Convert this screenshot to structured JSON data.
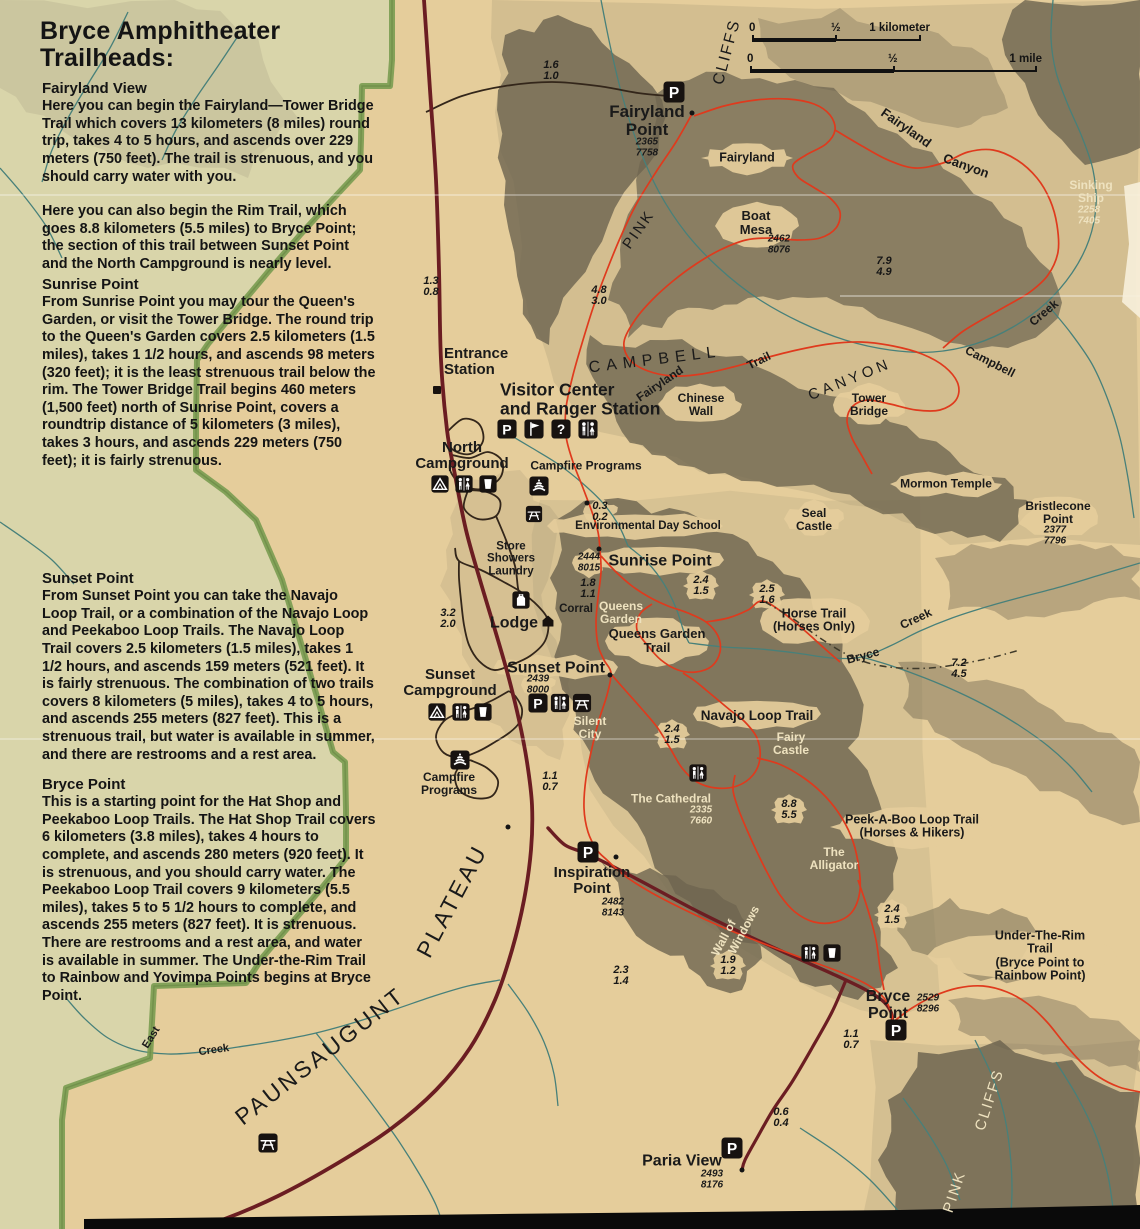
{
  "sidebar": {
    "title": "Bryce Amphitheater\nTrailheads:",
    "sections": [
      {
        "heading": "Fairyland View",
        "body": "Here you can begin the Fairyland—Tower Bridge Trail which covers 13 kilometers (8 miles) round trip, takes 4 to 5 hours, and ascends over 229 meters (750 feet). The trail is strenuous, and you should carry water with you."
      },
      {
        "heading": "",
        "body": "Here you can also begin the Rim Trail, which goes 8.8 kilometers (5.5 miles) to Bryce Point; the section of this trail between Sunset Point and the North Campground is nearly level."
      },
      {
        "heading": "Sunrise Point",
        "body": "From Sunrise Point you may tour the Queen's Garden, or visit the Tower Bridge. The round trip to the Queen's Garden covers 2.5 kilometers (1.5 miles), takes 1 1/2 hours, and ascends 98 meters (320 feet); it is the least strenuous trail below the rim. The Tower Bridge Trail begins 460 meters (1,500 feet) north of Sunrise Point, covers a roundtrip distance of 5 kilometers (3 miles), takes 3 hours, and ascends 229 meters (750 feet); it is fairly strenuous."
      },
      {
        "heading": "Sunset Point",
        "body": "From Sunset Point you can take the Navajo Loop Trail, or a combination of the Navajo Loop and Peekaboo Loop Trails. The Navajo Loop Trail covers 2.5 kilometers (1.5 miles), takes 1 1/2 hours, and ascends 159 meters (521 feet). It is fairly strenuous. The combination of two trails covers 8 kilometers (5 miles), takes 4 to 5 hours, and ascends 255 meters (827 feet). This is a strenuous trail, but water is available in summer, and there are restrooms and a rest area."
      },
      {
        "heading": "Bryce Point",
        "body": "This is a starting point for the Hat Shop and Peekaboo Loop Trails. The Hat Shop Trail covers 6 kilometers (3.8 miles), takes 4 hours to complete, and ascends 280 meters (920 feet). It is strenuous, and you should carry water. The Peekaboo Loop Trail covers 9 kilometers (5.5 miles), takes 5 to 5 1/2 hours to complete, and ascends 255 meters (827 feet). It is strenuous. There are restrooms and a rest area, and water is available in summer. The Under-the-Rim Trail to Rainbow and Yovimpa Points begins at Bryce Point."
      }
    ]
  },
  "scale_bars": {
    "km": {
      "zero": "0",
      "half": "½",
      "end": "1 kilometer"
    },
    "mile": {
      "zero": "0",
      "half": "½",
      "end": "1 mile"
    }
  },
  "colors": {
    "paper": "#e5cd9b",
    "outside": "#d9d5aa",
    "boundary": "#7c9d53",
    "road": "#6b1d22",
    "trail": "#df3a1d",
    "creek": "#47807a",
    "terrain_dark": "#6e6550",
    "terrain_mid": "#a89a78",
    "ink": "#1a1a1a",
    "cream": "#eee2bf",
    "icon_bg": "#171210"
  },
  "map": {
    "labels": [
      {
        "id": "cliffs-upper-label",
        "t": "CLIFFS",
        "x": 727,
        "y": 52,
        "fs": 16,
        "rot": -75,
        "w": 500,
        "ls": 2
      },
      {
        "id": "pink-upper-label",
        "t": "PINK",
        "x": 639,
        "y": 230,
        "fs": 15,
        "rot": -55,
        "w": 500,
        "ls": 2
      },
      {
        "id": "fairyland-point-label",
        "t": "Fairyland\nPoint",
        "x": 647,
        "y": 121,
        "fs": 17,
        "w": 800
      },
      {
        "id": "fairyland-point-elev",
        "t": "2365\n7758",
        "x": 647,
        "y": 148,
        "fs": 10,
        "w": 700,
        "it": 1
      },
      {
        "id": "fairyland-area-label",
        "t": "Fairyland",
        "x": 747,
        "y": 158,
        "fs": 12.5,
        "w": 600
      },
      {
        "id": "boat-mesa-label",
        "t": "Boat\nMesa",
        "x": 756,
        "y": 223,
        "fs": 13,
        "w": 600
      },
      {
        "id": "boat-mesa-elev",
        "t": "2462\n8076",
        "x": 779,
        "y": 245,
        "fs": 10,
        "w": 700,
        "it": 1
      },
      {
        "id": "sinking-ship-label",
        "t": "Sinking\nShip",
        "x": 1091,
        "y": 192,
        "fs": 12,
        "w": 600,
        "c": "cream"
      },
      {
        "id": "sinking-ship-elev",
        "t": "2258\n7405",
        "x": 1089,
        "y": 216,
        "fs": 10,
        "w": 700,
        "it": 1,
        "c": "cream"
      },
      {
        "id": "fairyland-canyon-label-1",
        "t": "Fairyland",
        "x": 906,
        "y": 128,
        "fs": 13,
        "rot": 35,
        "w": 600
      },
      {
        "id": "fairyland-canyon-label-2",
        "t": "Canyon",
        "x": 966,
        "y": 166,
        "fs": 13,
        "rot": 20,
        "w": 600
      },
      {
        "id": "campbell-creek-label-1",
        "t": "Campbell",
        "x": 990,
        "y": 362,
        "fs": 12,
        "rot": 27,
        "w": 600
      },
      {
        "id": "campbell-creek-label-2",
        "t": "Creek",
        "x": 1044,
        "y": 313,
        "fs": 12,
        "rot": -40,
        "w": 600
      },
      {
        "id": "campbell-canyon-letters-1",
        "t": "CAMPBELL",
        "x": 655,
        "y": 360,
        "fs": 16,
        "ls": 6,
        "rot": -7,
        "w": 500
      },
      {
        "id": "campbell-canyon-letters-2",
        "t": "CANYON",
        "x": 850,
        "y": 380,
        "fs": 15,
        "ls": 4,
        "rot": -22,
        "w": 500
      },
      {
        "id": "fairyland-trail-label-1",
        "t": "Fairyland",
        "x": 660,
        "y": 384,
        "fs": 12,
        "rot": -34,
        "w": 700
      },
      {
        "id": "fairyland-trail-label-2",
        "t": "Trail",
        "x": 759,
        "y": 361,
        "fs": 12,
        "rot": -26,
        "w": 700
      },
      {
        "id": "chinese-wall-label",
        "t": "Chinese\nWall",
        "x": 701,
        "y": 405,
        "fs": 12,
        "w": 600
      },
      {
        "id": "tower-bridge-label",
        "t": "Tower\nBridge",
        "x": 869,
        "y": 405,
        "fs": 12,
        "w": 600
      },
      {
        "id": "entrance-station-label",
        "t": "Entrance\nStation",
        "x": 444,
        "y": 362,
        "fs": 15,
        "w": 800,
        "al": "l"
      },
      {
        "id": "visitor-center-label",
        "t": "Visitor Center\nand Ranger Station",
        "x": 500,
        "y": 399,
        "fs": 17.5,
        "w": 800,
        "al": "l"
      },
      {
        "id": "north-campground-label",
        "t": "North\nCampground",
        "x": 462,
        "y": 456,
        "fs": 15,
        "w": 800
      },
      {
        "id": "campfire-programs-north-label",
        "t": "Campfire Programs",
        "x": 586,
        "y": 466,
        "fs": 12,
        "w": 600
      },
      {
        "id": "environmental-day-school-label",
        "t": "Environmental Day School",
        "x": 648,
        "y": 526,
        "fs": 11.5,
        "w": 600
      },
      {
        "id": "store-showers-laundry-label",
        "t": "Store\nShowers\nLaundry",
        "x": 511,
        "y": 559,
        "fs": 11.5,
        "w": 600
      },
      {
        "id": "sunrise-point-label",
        "t": "Sunrise Point",
        "x": 660,
        "y": 561,
        "fs": 16,
        "w": 800
      },
      {
        "id": "sunrise-point-elev",
        "t": "2444\n8015",
        "x": 589,
        "y": 563,
        "fs": 10,
        "w": 700,
        "it": 1
      },
      {
        "id": "corral-label",
        "t": "Corral",
        "x": 576,
        "y": 609,
        "fs": 11.5,
        "w": 600
      },
      {
        "id": "queens-garden-label",
        "t": "Queens\nGarden",
        "x": 621,
        "y": 613,
        "fs": 12,
        "w": 600,
        "c": "cream"
      },
      {
        "id": "queens-garden-trail-label",
        "t": "Queens Garden\nTrail",
        "x": 657,
        "y": 641,
        "fs": 13,
        "w": 800
      },
      {
        "id": "horse-trail-label",
        "t": "Horse Trail\n(Horses Only)",
        "x": 814,
        "y": 621,
        "fs": 12.5,
        "w": 800
      },
      {
        "id": "bryce-creek-label-1",
        "t": "Bryce",
        "x": 863,
        "y": 656,
        "fs": 12,
        "rot": -15,
        "w": 600
      },
      {
        "id": "bryce-creek-label-2",
        "t": "Creek",
        "x": 916,
        "y": 619,
        "fs": 12,
        "rot": -25,
        "w": 600
      },
      {
        "id": "lodge-label",
        "t": "Lodge",
        "x": 514,
        "y": 623,
        "fs": 16,
        "w": 800
      },
      {
        "id": "sunset-point-label",
        "t": "Sunset Point",
        "x": 556,
        "y": 668,
        "fs": 16,
        "w": 800
      },
      {
        "id": "sunset-point-elev",
        "t": "2439\n8000",
        "x": 538,
        "y": 685,
        "fs": 10,
        "w": 700,
        "it": 1
      },
      {
        "id": "sunset-campground-label",
        "t": "Sunset\nCampground",
        "x": 450,
        "y": 683,
        "fs": 15,
        "w": 800
      },
      {
        "id": "silent-city-label",
        "t": "Silent\nCity",
        "x": 590,
        "y": 728,
        "fs": 12,
        "w": 600,
        "c": "cream"
      },
      {
        "id": "navajo-loop-trail-label",
        "t": "Navajo Loop Trail",
        "x": 757,
        "y": 716,
        "fs": 13.5,
        "w": 800
      },
      {
        "id": "fairy-castle-label",
        "t": "Fairy\nCastle",
        "x": 791,
        "y": 744,
        "fs": 12,
        "w": 600,
        "c": "cream"
      },
      {
        "id": "the-cathedral-label",
        "t": "The Cathedral",
        "x": 671,
        "y": 799,
        "fs": 12,
        "w": 600,
        "c": "cream"
      },
      {
        "id": "the-cathedral-elev",
        "t": "2335\n7660",
        "x": 701,
        "y": 816,
        "fs": 10,
        "w": 700,
        "it": 1,
        "c": "cream"
      },
      {
        "id": "peek-a-boo-loop-trail-label",
        "t": "Peek-A-Boo Loop Trail\n(Horses & Hikers)",
        "x": 912,
        "y": 827,
        "fs": 12.5,
        "w": 800
      },
      {
        "id": "the-alligator-label",
        "t": "The\nAlligator",
        "x": 834,
        "y": 859,
        "fs": 12,
        "w": 600,
        "c": "cream"
      },
      {
        "id": "campfire-programs-south-label",
        "t": "Campfire\nPrograms",
        "x": 449,
        "y": 784,
        "fs": 12,
        "w": 600
      },
      {
        "id": "inspiration-point-label",
        "t": "Inspiration\nPoint",
        "x": 592,
        "y": 881,
        "fs": 15,
        "w": 800
      },
      {
        "id": "inspiration-point-elev",
        "t": "2482\n8143",
        "x": 613,
        "y": 908,
        "fs": 10,
        "w": 700,
        "it": 1
      },
      {
        "id": "wall-of-windows-label-1",
        "t": "Wall of",
        "x": 724,
        "y": 938,
        "fs": 12,
        "rot": -62,
        "w": 600,
        "c": "cream"
      },
      {
        "id": "wall-of-windows-label-2",
        "t": "Windows",
        "x": 744,
        "y": 930,
        "fs": 12,
        "rot": -62,
        "w": 600,
        "c": "cream"
      },
      {
        "id": "bryce-point-label",
        "t": "Bryce\nPoint",
        "x": 888,
        "y": 1005,
        "fs": 16,
        "w": 800
      },
      {
        "id": "bryce-point-elev",
        "t": "2529\n8296",
        "x": 928,
        "y": 1004,
        "fs": 10,
        "w": 700,
        "it": 1
      },
      {
        "id": "under-the-rim-trail-label",
        "t": "Under-The-Rim Trail\n(Bryce Point to Rainbow Point)",
        "x": 1040,
        "y": 956,
        "fs": 12.5,
        "w": 800
      },
      {
        "id": "paria-view-label",
        "t": "Paria View",
        "x": 682,
        "y": 1161,
        "fs": 16,
        "w": 800
      },
      {
        "id": "paria-view-elev",
        "t": "2493\n8176",
        "x": 712,
        "y": 1180,
        "fs": 10,
        "w": 700,
        "it": 1
      },
      {
        "id": "paunsaugunt-label",
        "t": "PAUNSAUGUNT",
        "x": 320,
        "y": 1056,
        "fs": 23,
        "ls": 3,
        "rot": -38,
        "w": 500
      },
      {
        "id": "plateau-label",
        "t": "PLATEAU",
        "x": 452,
        "y": 901,
        "fs": 23,
        "ls": 3,
        "rot": -62,
        "w": 500
      },
      {
        "id": "east-creek-label-1",
        "t": "East",
        "x": 152,
        "y": 1038,
        "fs": 11,
        "rot": -58,
        "w": 600
      },
      {
        "id": "east-creek-label-2",
        "t": "Creek",
        "x": 214,
        "y": 1051,
        "fs": 11,
        "rot": -8,
        "w": 600
      },
      {
        "id": "pink-lower-label",
        "t": "PINK",
        "x": 955,
        "y": 1192,
        "fs": 15,
        "rot": -72,
        "w": 500,
        "ls": 2,
        "c": "cream"
      },
      {
        "id": "cliffs-lower-label",
        "t": "CLIFFS",
        "x": 990,
        "y": 1100,
        "fs": 15,
        "rot": -72,
        "w": 500,
        "ls": 2,
        "c": "cream"
      },
      {
        "id": "mormon-temple-label",
        "t": "Mormon Temple",
        "x": 946,
        "y": 484,
        "fs": 12,
        "w": 600
      },
      {
        "id": "seal-castle-label",
        "t": "Seal\nCastle",
        "x": 814,
        "y": 520,
        "fs": 12,
        "w": 600
      },
      {
        "id": "bristlecone-point-label",
        "t": "Bristlecone\nPoint",
        "x": 1058,
        "y": 513,
        "fs": 12,
        "w": 600
      },
      {
        "id": "bristlecone-point-elev",
        "t": "2377\n7796",
        "x": 1055,
        "y": 536,
        "fs": 10,
        "w": 700,
        "it": 1
      }
    ],
    "distances": [
      {
        "x": 551,
        "y": 71,
        "a": "1.6",
        "b": "1.0"
      },
      {
        "x": 431,
        "y": 287,
        "a": "1.3",
        "b": "0.8"
      },
      {
        "x": 599,
        "y": 296,
        "a": "4.8",
        "b": "3.0"
      },
      {
        "x": 884,
        "y": 267,
        "a": "7.9",
        "b": "4.9"
      },
      {
        "x": 600,
        "y": 512,
        "a": "0.3",
        "b": "0.2"
      },
      {
        "x": 588,
        "y": 589,
        "a": "1.8",
        "b": "1.1"
      },
      {
        "x": 701,
        "y": 586,
        "a": "2.4",
        "b": "1.5"
      },
      {
        "x": 767,
        "y": 595,
        "a": "2.5",
        "b": "1.6"
      },
      {
        "x": 448,
        "y": 619,
        "a": "3.2",
        "b": "2.0"
      },
      {
        "x": 959,
        "y": 669,
        "a": "7.2",
        "b": "4.5"
      },
      {
        "x": 672,
        "y": 735,
        "a": "2.4",
        "b": "1.5"
      },
      {
        "x": 789,
        "y": 810,
        "a": "8.8",
        "b": "5.5"
      },
      {
        "x": 550,
        "y": 782,
        "a": "1.1",
        "b": "0.7"
      },
      {
        "x": 621,
        "y": 976,
        "a": "2.3",
        "b": "1.4"
      },
      {
        "x": 728,
        "y": 966,
        "a": "1.9",
        "b": "1.2"
      },
      {
        "x": 892,
        "y": 915,
        "a": "2.4",
        "b": "1.5"
      },
      {
        "x": 851,
        "y": 1040,
        "a": "1.1",
        "b": "0.7"
      },
      {
        "x": 781,
        "y": 1118,
        "a": "0.6",
        "b": "0.4"
      }
    ],
    "icons": [
      {
        "t": "parking",
        "x": 674,
        "y": 92,
        "s": 22
      },
      {
        "t": "parking",
        "x": 507,
        "y": 429,
        "s": 20
      },
      {
        "t": "flag",
        "x": 534,
        "y": 429,
        "s": 20
      },
      {
        "t": "question",
        "x": 561,
        "y": 429,
        "s": 20
      },
      {
        "t": "restroom",
        "x": 588,
        "y": 429,
        "s": 20
      },
      {
        "t": "tent",
        "x": 440,
        "y": 484,
        "s": 18
      },
      {
        "t": "restroom",
        "x": 464,
        "y": 484,
        "s": 18
      },
      {
        "t": "water",
        "x": 488,
        "y": 484,
        "s": 18
      },
      {
        "t": "campfire",
        "x": 539,
        "y": 486,
        "s": 20
      },
      {
        "t": "picnic",
        "x": 534,
        "y": 514,
        "s": 17
      },
      {
        "t": "store",
        "x": 521,
        "y": 600,
        "s": 18
      },
      {
        "t": "lodge",
        "x": 548,
        "y": 621,
        "s": 15
      },
      {
        "t": "parking",
        "x": 538,
        "y": 703,
        "s": 20
      },
      {
        "t": "restroom",
        "x": 560,
        "y": 703,
        "s": 19
      },
      {
        "t": "picnic",
        "x": 582,
        "y": 703,
        "s": 19
      },
      {
        "t": "tent",
        "x": 437,
        "y": 712,
        "s": 18
      },
      {
        "t": "restroom",
        "x": 461,
        "y": 712,
        "s": 18
      },
      {
        "t": "water",
        "x": 483,
        "y": 712,
        "s": 18
      },
      {
        "t": "campfire",
        "x": 460,
        "y": 760,
        "s": 20
      },
      {
        "t": "restroom",
        "x": 698,
        "y": 773,
        "s": 18
      },
      {
        "t": "parking",
        "x": 588,
        "y": 852,
        "s": 22
      },
      {
        "t": "restroom",
        "x": 810,
        "y": 953,
        "s": 18
      },
      {
        "t": "water",
        "x": 832,
        "y": 953,
        "s": 18
      },
      {
        "t": "parking",
        "x": 896,
        "y": 1030,
        "s": 22
      },
      {
        "t": "parking",
        "x": 732,
        "y": 1148,
        "s": 22
      },
      {
        "t": "picnic",
        "x": 268,
        "y": 1143,
        "s": 20
      },
      {
        "t": "building",
        "x": 437,
        "y": 390,
        "s": 11
      }
    ],
    "dots": [
      {
        "x": 692,
        "y": 113
      },
      {
        "x": 599,
        "y": 549
      },
      {
        "x": 610,
        "y": 675
      },
      {
        "x": 616,
        "y": 857
      },
      {
        "x": 742,
        "y": 1170
      },
      {
        "x": 587,
        "y": 503
      },
      {
        "x": 508,
        "y": 827
      }
    ]
  }
}
